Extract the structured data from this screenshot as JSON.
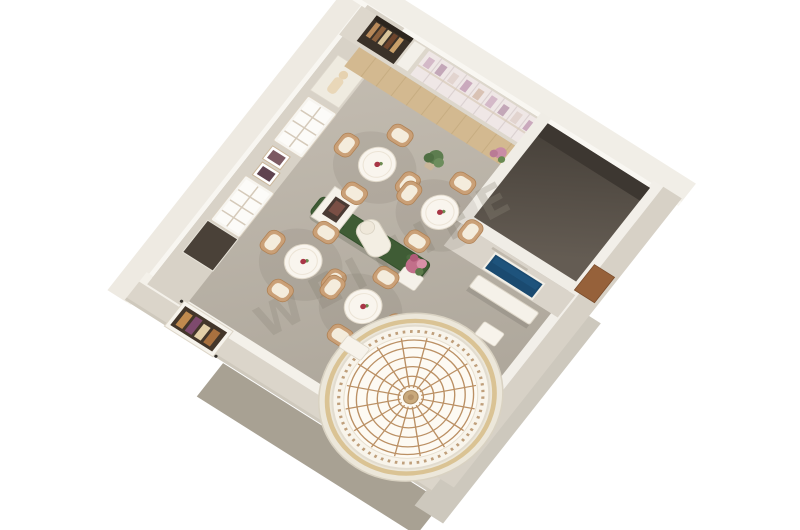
{
  "scene": {
    "title": "3D interior floor plan render",
    "watermark": {
      "text": "WEINIFE"
    },
    "counts": {
      "dining_tables": 4,
      "chairs_per_table": 4
    },
    "colors": {
      "background": "#ffffff",
      "floor": "#b7b0a5",
      "wall_top": "#efece5",
      "wall_face": "#d8d2c7",
      "ground_shadow": "#a8a193",
      "hedge_green": "#3f5c35",
      "dome_frame": "#bb9064",
      "tv_screen": "#1a4a70",
      "chair_trim": "#caa077",
      "wood_floor": "#d3b990",
      "flowers_pink": "#c26f8a"
    }
  }
}
